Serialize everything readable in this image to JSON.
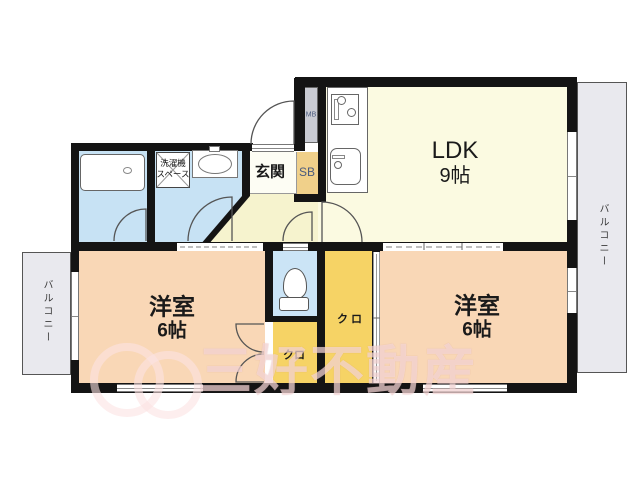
{
  "rooms": {
    "ldk": {
      "name": "LDK",
      "size": "9帖"
    },
    "western_left": {
      "name": "洋室",
      "size": "6帖"
    },
    "western_right": {
      "name": "洋室",
      "size": "6帖"
    },
    "entrance": {
      "name": "玄関"
    },
    "shoe_box": {
      "name": "SB"
    },
    "meter_box": {
      "name": "MB"
    },
    "closet_center": {
      "name": "クロ"
    },
    "closet_side": {
      "name": "クロ"
    },
    "laundry_space": {
      "line1": "洗濯機",
      "line2": "スペース"
    },
    "balcony_left": {
      "name": "バルコニー"
    },
    "balcony_right": {
      "name": "バルコニー"
    }
  },
  "watermark": {
    "company": "三好不動産"
  },
  "colors": {
    "wall": "#141414",
    "ldk_floor": "#FBFAE1",
    "hall_floor": "#F6F3CE",
    "room_floor": "#F9D7B6",
    "closet": "#F6D365",
    "shoe_box": "#F0D08A",
    "wet_area": "#C7E2F4",
    "toilet": "#CBE4F6",
    "balcony": "#E9E9EE",
    "meter_box": "#C9CBD3",
    "watermark_tint": "#F2BFBF"
  }
}
